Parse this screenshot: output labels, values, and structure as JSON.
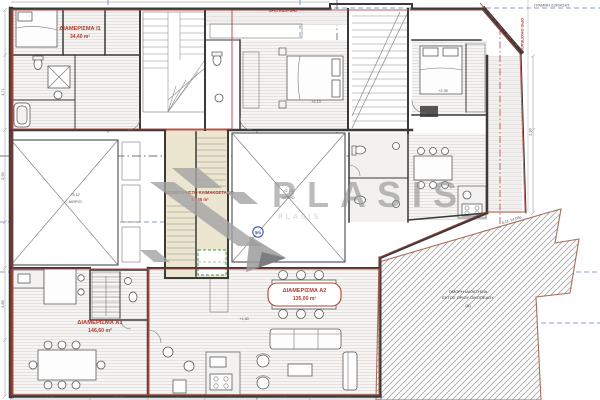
{
  "plan": {
    "apartments": {
      "i1": {
        "name": "ΔΙΑΜΕΡΙΣΜΑ Ι1",
        "area": "34,40 m²"
      },
      "a1": {
        "name": "ΔΙΑΜΕΡΙΣΜΑ Α1",
        "area": "146,60 m²"
      },
      "a2": {
        "name": "ΔΙΑΜΕΡΙΣΜΑ Α2",
        "area": "135,00 m²"
      },
      "stair": {
        "name": "ΚΟΙΝΟΧΡΗΣΤΟ ΚΛΙΜΑΚΟΣΤΑΣΙΟ",
        "area": "12,35 m²"
      }
    },
    "rooms": {
      "light_well": "ΑΙΘΡΙΟ"
    },
    "levels": {
      "l1": "+2,35",
      "l2": "+2,13",
      "l3": "+1,50",
      "l4": "+3,12"
    },
    "dims": {
      "d1": "4,71",
      "d2": "3,85",
      "d3": "1,20",
      "d4": "2,70",
      "d5": "3,40",
      "d6": "1,98",
      "d7": "4,28",
      "d8": "2,90"
    },
    "site": {
      "plot_note_1": "ΟΜΟΡΗ ΙΔΙΟΚΤΗΣΙΑ",
      "plot_note_2": "ΕΚΤΟΣ ΟΡΙΟΥ ΟΙΚΟΠΕΔΟΥ",
      "plot_note_3": "(Α)",
      "boundary_label": "ΟΡΙΟ ΟΙΚΟΠΕΔΟΥ",
      "buildline_label": "ΓΡΑΜΜΗ ΔΟΜΗΣΗΣ",
      "cover_label": "ΟΡΙΟ ΚΑΛΥΨΗΣ",
      "road_label": "Δ.Ο. 14,00μ",
      "marker": "5m"
    },
    "watermark": {
      "text": "PLASIS",
      "echo": "PLASIS"
    },
    "colors": {
      "accent_red": "#b03a2e",
      "boundary_brown": "#a5705d",
      "grid_blue": "#3a57a8",
      "watermark_gray": "#8f8f8f",
      "wall_dark": "#3a3a3a",
      "stair_cream": "#ece5cf",
      "elevator_green": "#3f9b43"
    }
  }
}
